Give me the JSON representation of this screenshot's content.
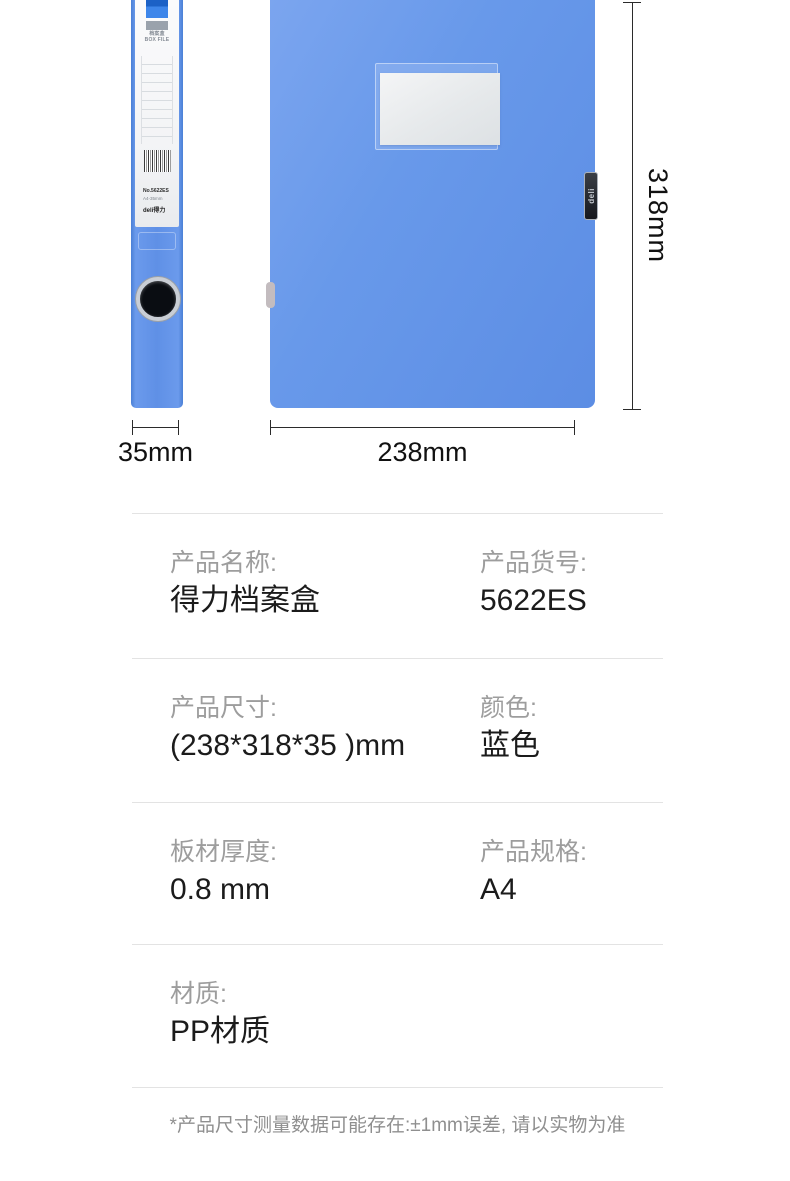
{
  "gallery": {
    "spine": {
      "header_cn": "档案盒",
      "header_en": "BOX FILE",
      "sku": "No.5622ES",
      "spec": "A4-35mm",
      "brand": "deli得力"
    },
    "front": {
      "clip_brand": "deli"
    },
    "dims": {
      "height": "318mm",
      "width": "238mm",
      "depth": "35mm"
    }
  },
  "specs": {
    "rows": [
      {
        "label1": "产品名称:",
        "value1": "得力档案盒",
        "label2": "产品货号:",
        "value2": "5622ES"
      },
      {
        "label1": "产品尺寸:",
        "value1": "(238*318*35 )mm",
        "label2": "颜色:",
        "value2": "蓝色"
      },
      {
        "label1": "板材厚度:",
        "value1": "0.8 mm",
        "label2": "产品规格:",
        "value2": "A4"
      },
      {
        "label1": "材质:",
        "value1": "PP材质"
      }
    ]
  },
  "footnote": "*产品尺寸测量数据可能存在:±1mm误差, 请以实物为准",
  "colors": {
    "box_blue": "#6394e8",
    "box_blue_light": "#7aa4ee",
    "box_blue_dark": "#5a8be2",
    "label_card_gray": "#e0e3e6",
    "spec_label_gray": "#9d9d9d",
    "spec_value_dark": "#1b1b1b",
    "divider_gray": "#e3e3e3",
    "dimension_ink": "#111111"
  }
}
